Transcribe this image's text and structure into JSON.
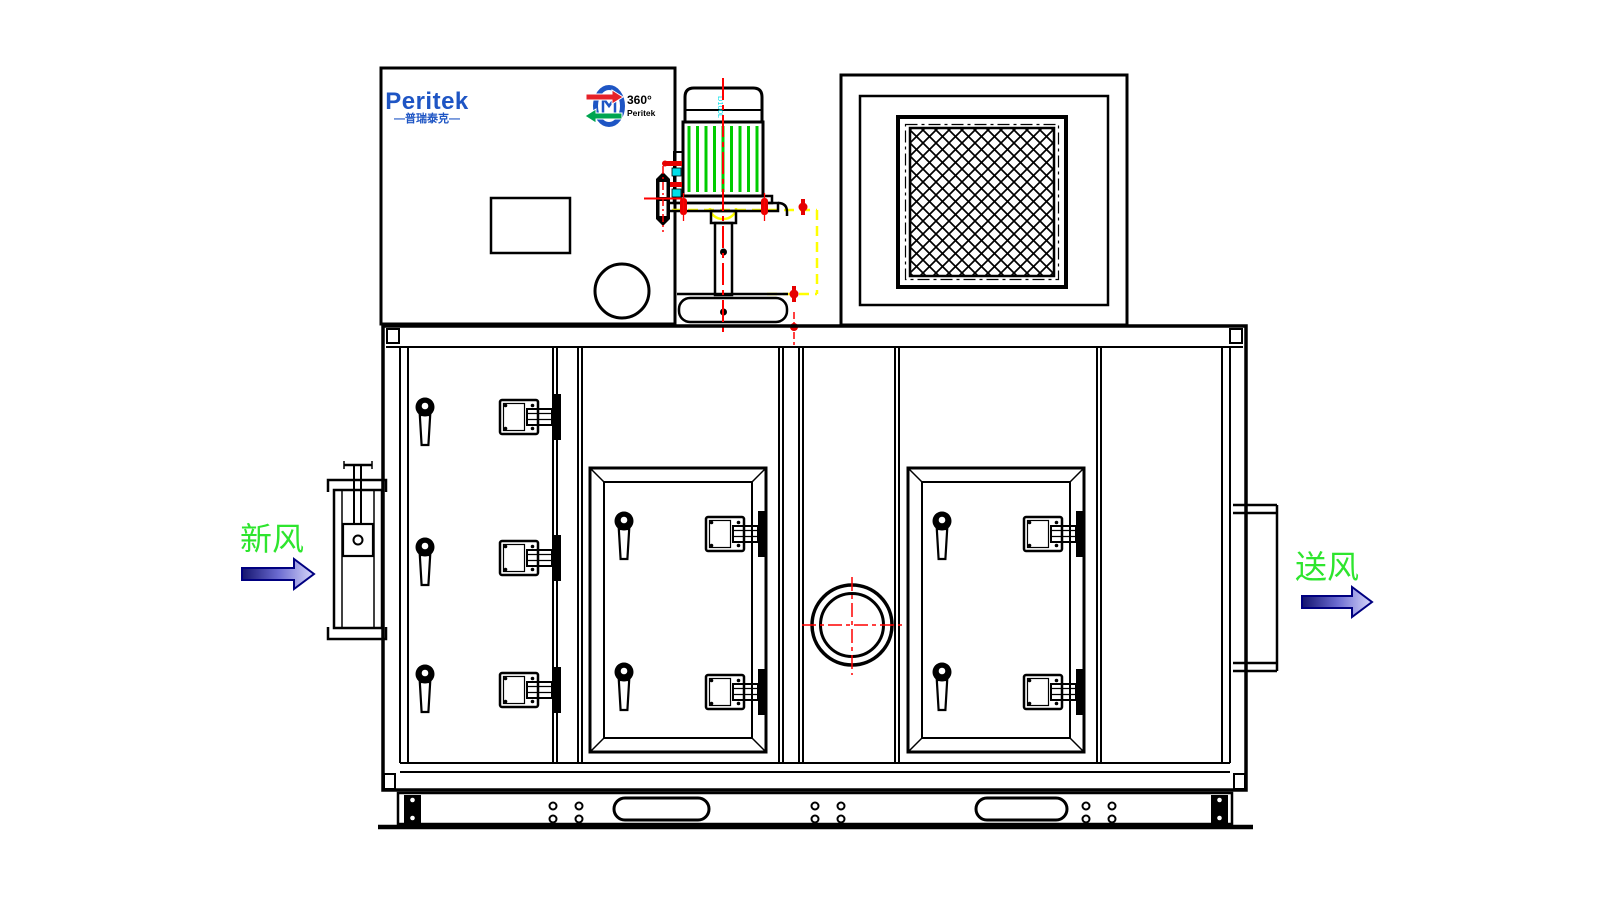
{
  "brand": {
    "name": "Peritek",
    "tagline_cn": "—普瑞泰克—"
  },
  "logo_360": {
    "degrees": "360°",
    "brand": "Peritek"
  },
  "motor": {
    "frame_label": "D100L"
  },
  "flow_labels": {
    "fresh_air": "新风",
    "supply_air": "送风"
  },
  "colors": {
    "logo_blue": "#1E55C4",
    "logo_red": "#E62129",
    "logo_green": "#00A550",
    "motor_fin_green": "#00CC00",
    "highlight_yellow": "#FFFF00",
    "centerline_red": "#FF0000",
    "hardware_red": "#E60000",
    "detail_cyan": "#00DFE8",
    "flow_label_green": "#2EE52E",
    "arrow_blue_dark": "#14146E",
    "arrow_blue_light": "#D8D8FA",
    "line_black": "#000000"
  }
}
